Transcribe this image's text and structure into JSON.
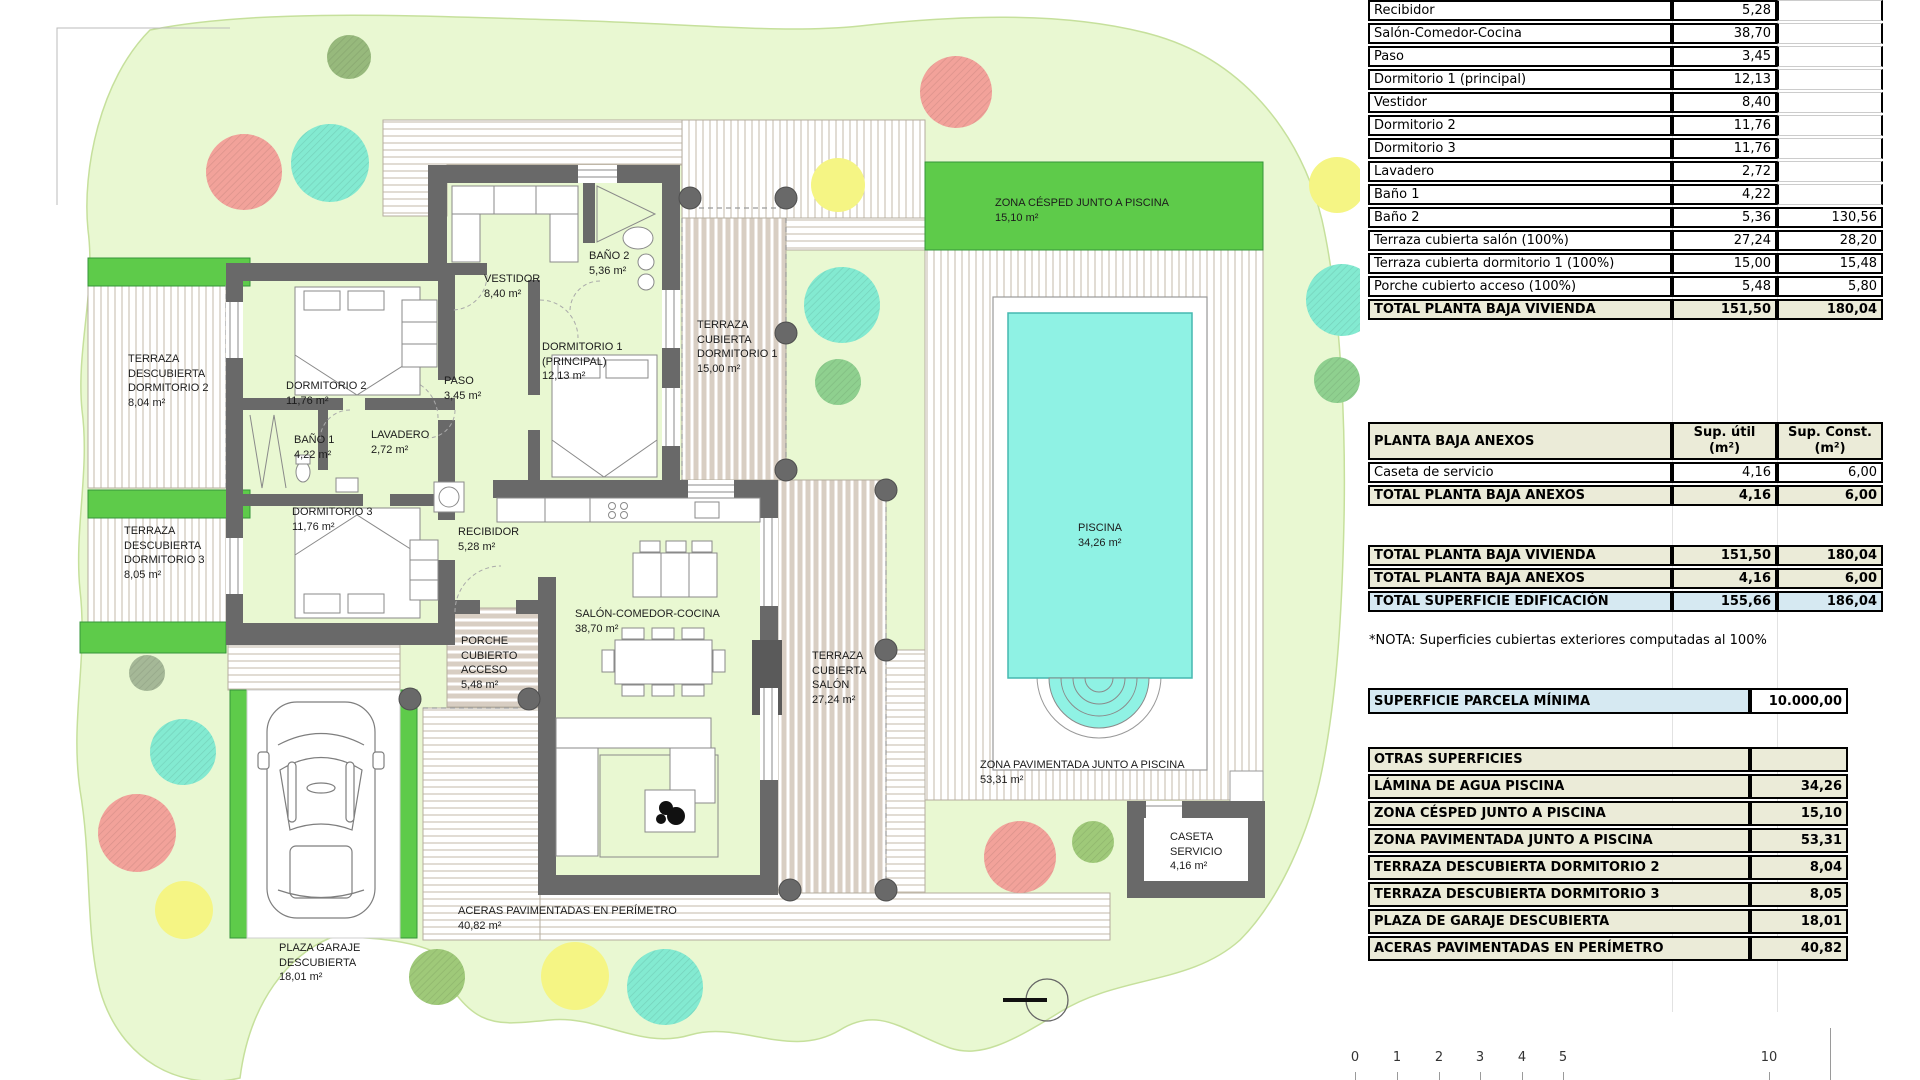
{
  "plan": {
    "labels": [
      {
        "name": "TERRAZA\nDESCUBIERTA\nDORMITORIO 2",
        "area": "8,04 m²"
      },
      {
        "name": "DORMITORIO 2",
        "area": "11,76 m²"
      },
      {
        "name": "VESTIDOR",
        "area": "8,40 m²"
      },
      {
        "name": "BAÑO 2",
        "area": "5,36 m²"
      },
      {
        "name": "TERRAZA\nCUBIERTA\nDORMITORIO 1",
        "area": "15,00 m²"
      },
      {
        "name": "DORMITORIO 1\n(PRINCIPAL)",
        "area": "12,13 m²"
      },
      {
        "name": "PASO",
        "area": "3,45 m²"
      },
      {
        "name": "BAÑO 1",
        "area": "4,22 m²"
      },
      {
        "name": "LAVADERO",
        "area": "2,72 m²"
      },
      {
        "name": "DORMITORIO 3",
        "area": "11,76 m²"
      },
      {
        "name": "TERRAZA\nDESCUBIERTA\nDORMITORIO 3",
        "area": "8,05 m²"
      },
      {
        "name": "RECIBIDOR",
        "area": "5,28 m²"
      },
      {
        "name": "SALÓN-COMEDOR-COCINA",
        "area": "38,70 m²"
      },
      {
        "name": "PORCHE\nCUBIERTO\nACCESO",
        "area": "5,48 m²"
      },
      {
        "name": "TERRAZA\nCUBIERTA\nSALÓN",
        "area": "27,24 m²"
      },
      {
        "name": "ZONA CÉSPED JUNTO A PISCINA",
        "area": "15,10 m²"
      },
      {
        "name": "PISCINA",
        "area": "34,26 m²"
      },
      {
        "name": "ZONA PAVIMENTADA JUNTO A PISCINA",
        "area": "53,31 m²"
      },
      {
        "name": "CASETA\nSERVICIO",
        "area": "4,16 m²"
      },
      {
        "name": "ACERAS PAVIMENTADAS EN PERÍMETRO",
        "area": "40,82 m²"
      },
      {
        "name": "PLAZA GARAJE\nDESCUBIERTA",
        "area": "18,01 m²"
      }
    ]
  },
  "scalebar": {
    "ticks": [
      "0",
      "1",
      "2",
      "3",
      "4",
      "5",
      "10"
    ]
  },
  "tables": {
    "vivienda": {
      "rows": [
        {
          "label": "Recibidor",
          "util": "5,28",
          "konst": ""
        },
        {
          "label": "Salón-Comedor-Cocina",
          "util": "38,70",
          "konst": ""
        },
        {
          "label": "Paso",
          "util": "3,45",
          "konst": ""
        },
        {
          "label": "Dormitorio 1 (principal)",
          "util": "12,13",
          "konst": ""
        },
        {
          "label": "Vestidor",
          "util": "8,40",
          "konst": ""
        },
        {
          "label": "Dormitorio 2",
          "util": "11,76",
          "konst": ""
        },
        {
          "label": "Dormitorio 3",
          "util": "11,76",
          "konst": ""
        },
        {
          "label": "Lavadero",
          "util": "2,72",
          "konst": ""
        },
        {
          "label": "Baño 1",
          "util": "4,22",
          "konst": ""
        },
        {
          "label": "Baño 2",
          "util": "5,36",
          "konst": "130,56"
        },
        {
          "label": "Terraza cubierta salón (100%)",
          "util": "27,24",
          "konst": "28,20"
        },
        {
          "label": "Terraza cubierta dormitorio 1 (100%)",
          "util": "15,00",
          "konst": "15,48"
        },
        {
          "label": "Porche cubierto acceso (100%)",
          "util": "5,48",
          "konst": "5,80"
        }
      ],
      "total": {
        "label": "TOTAL PLANTA BAJA VIVIENDA",
        "util": "151,50",
        "konst": "180,04"
      }
    },
    "anexos": {
      "header": {
        "label": "PLANTA BAJA ANEXOS",
        "util": "Sup. útil\n(m²)",
        "konst": "Sup. Const.\n(m²)"
      },
      "rows": [
        {
          "label": "Caseta de servicio",
          "util": "4,16",
          "konst": "6,00"
        }
      ],
      "total": {
        "label": "TOTAL PLANTA BAJA ANEXOS",
        "util": "4,16",
        "konst": "6,00"
      }
    },
    "resumen": {
      "rows": [
        {
          "label": "TOTAL PLANTA BAJA VIVIENDA",
          "util": "151,50",
          "konst": "180,04"
        },
        {
          "label": "TOTAL PLANTA BAJA ANEXOS",
          "util": "4,16",
          "konst": "6,00"
        },
        {
          "label": "TOTAL SUPERFICIE EDIFICACIÓN",
          "util": "155,66",
          "konst": "186,04"
        }
      ]
    },
    "note": "*NOTA: Superficies cubiertas exteriores computadas al 100%",
    "parcela": {
      "label": "SUPERFICIE PARCELA MÍNIMA",
      "value": "10.000,00"
    },
    "otras": {
      "header": "OTRAS SUPERFICIES",
      "rows": [
        {
          "label": "LÁMINA DE AGUA PISCINA",
          "value": "34,26"
        },
        {
          "label": "ZONA CÉSPED JUNTO A PISCINA",
          "value": "15,10"
        },
        {
          "label": "ZONA PAVIMENTADA JUNTO A PISCINA",
          "value": "53,31"
        },
        {
          "label": "TERRAZA DESCUBIERTA DORMITORIO 2",
          "value": "8,04"
        },
        {
          "label": "TERRAZA DESCUBIERTA DORMITORIO 3",
          "value": "8,05"
        },
        {
          "label": "PLAZA DE GARAJE DESCUBIERTA",
          "value": "18,01"
        },
        {
          "label": "ACERAS PAVIMENTADAS EN PERÍMETRO",
          "value": "40,82"
        }
      ]
    },
    "colors": {
      "section_beige": "#ebebd8",
      "highlight_blue": "#d6e9f2"
    }
  }
}
